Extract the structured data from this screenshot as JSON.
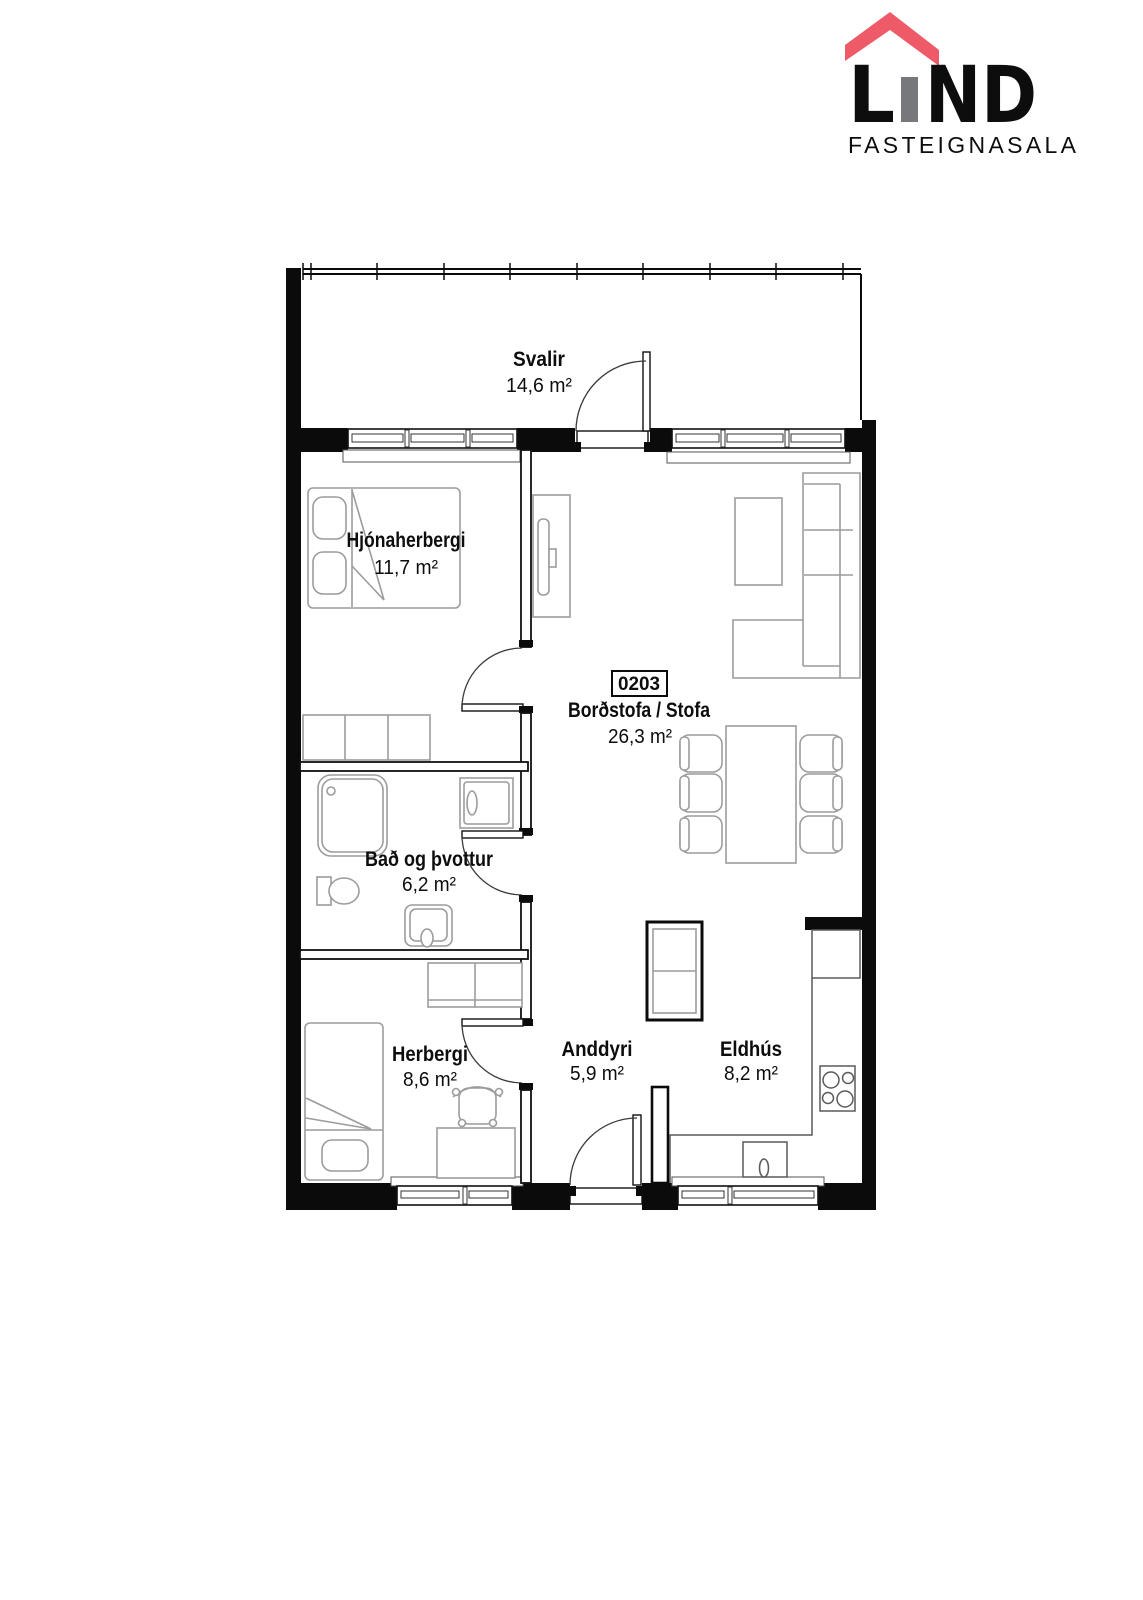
{
  "logo": {
    "brand_full": "LIND",
    "brand_l": "L",
    "brand_nd": "ND",
    "subtitle": "FASTEIGNASALA",
    "colors": {
      "gray": "#77787b",
      "red": "#ee5a67"
    }
  },
  "unit": {
    "number": "0203"
  },
  "rooms": [
    {
      "id": "svalir",
      "name": "Svalir",
      "area": "14,6 m²"
    },
    {
      "id": "hjonaherbergi",
      "name": "Hjónaherbergi",
      "area": "11,7 m²"
    },
    {
      "id": "stofa",
      "name": "Borðstofa / Stofa",
      "area": "26,3 m²"
    },
    {
      "id": "bad",
      "name": "Bað og þvottur",
      "area": "6,2 m²"
    },
    {
      "id": "herbergi",
      "name": "Herbergi",
      "area": "8,6 m²"
    },
    {
      "id": "anddyri",
      "name": "Anddyri",
      "area": "5,9 m²"
    },
    {
      "id": "eldhus",
      "name": "Eldhús",
      "area": "8,2 m²"
    }
  ]
}
